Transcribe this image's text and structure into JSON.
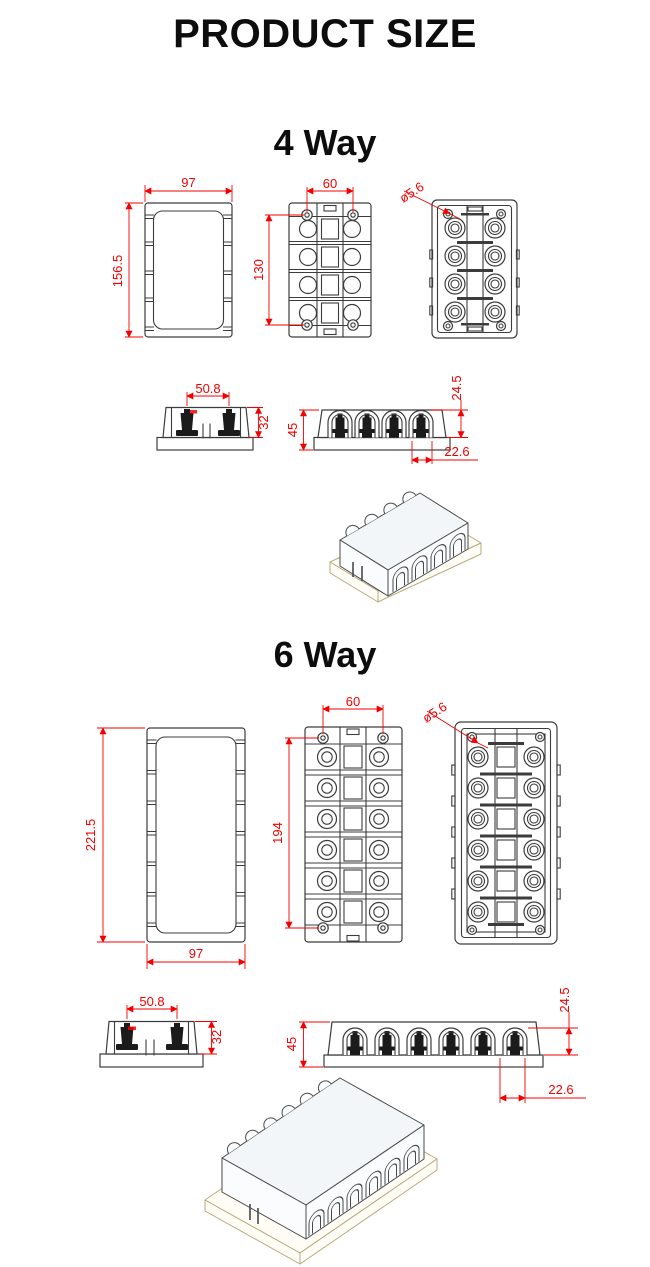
{
  "page": {
    "title": "PRODUCT SIZE"
  },
  "colors": {
    "dimension_red": "#f40000",
    "drawing_line": "#3c3c3c",
    "iso_base_tan": "#b9a97b"
  },
  "sections": [
    {
      "id": "4way",
      "heading": "4 Way",
      "dims": {
        "cover_width": "97",
        "cover_height": "156.5",
        "screw_pitch_x": "60",
        "screw_pitch_y": "130",
        "hole_diameter": "ø5.6",
        "stud_pitch": "50.8",
        "body_height": "32",
        "overall_height": "45",
        "terminal_height": "24.5",
        "terminal_offset": "22.6"
      }
    },
    {
      "id": "6way",
      "heading": "6 Way",
      "dims": {
        "cover_width": "97",
        "cover_height": "221.5",
        "screw_pitch_x": "60",
        "screw_pitch_y": "194",
        "hole_diameter": "ø5.6",
        "stud_pitch": "50.8",
        "body_height": "32",
        "overall_height": "45",
        "terminal_height": "24.5",
        "terminal_offset": "22.6"
      }
    }
  ]
}
